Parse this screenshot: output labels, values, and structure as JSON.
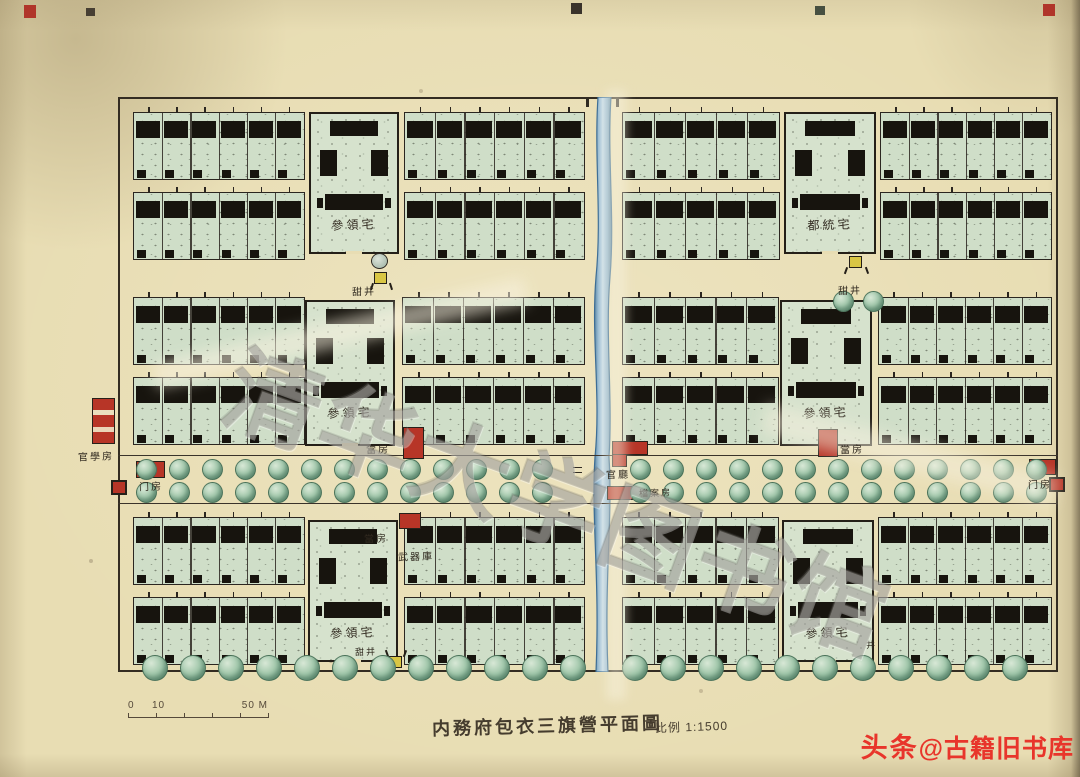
{
  "document": {
    "watermark": "清华大学图书馆",
    "title": "内務府包衣三旗營平面圖",
    "scale_note": "比例 1:1500",
    "scale_bar": {
      "start": "0",
      "mid": "10",
      "end": "50 M"
    },
    "credit": {
      "brand": "头条",
      "handle": "@古籍旧书库"
    }
  },
  "plan_labels": {
    "canling_residence": "參領宅",
    "dutong_residence": "都統宅",
    "sweet_well": "甜井",
    "well": "井",
    "pawn_house": "當房",
    "official_hall": "官廳",
    "archive_house": "檔案房",
    "official_school": "官學房",
    "gate_house": "门房",
    "armory": "武器庫"
  },
  "colors": {
    "paper": "#e8ddb3",
    "ink": "#2f2921",
    "roof_black": "#17140e",
    "wash_green": "#cfdec8",
    "tree_green": "#8fbc9d",
    "stream_blue": "#7fa9c6",
    "accent_red": "#b73527",
    "well_yellow": "#d9c644",
    "watermark_gray": "#8a8a8a",
    "credit_red": "#e8352b"
  }
}
